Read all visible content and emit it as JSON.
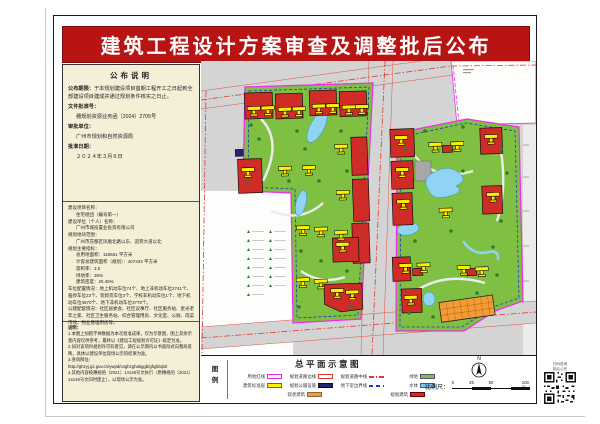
{
  "banner": {
    "title": "建筑工程设计方案审查及调整批后公布"
  },
  "panel": {
    "s1_title": "公布说明",
    "s1": [
      {
        "label": "公布期限：",
        "value": "于本规划建设项目首期工程开工之日起到全部建设项目建成并通过规划条件核实之日止。"
      },
      {
        "label": "文件批准号：",
        "value": "穗规划资源业务函〔2024〕2705号"
      },
      {
        "label": "审批单位：",
        "value": "广州市规划和自然资源局"
      },
      {
        "label": "批准日期：",
        "value": "２０２４年３月６日"
      }
    ],
    "s2": [
      {
        "label": "建设项目名称：",
        "value": "住宅组团（编号第一）"
      },
      {
        "label": "建设单位（个人）名称：",
        "value": "广州市城投置业投资有限公司"
      },
      {
        "label": "规划地块范围：",
        "value": "广州市花都区凤凰北路以东、迎宾大道以北"
      },
      {
        "label": "规划主要指标：",
        "value": ""
      },
      {
        "label": "",
        "value": "总用地面积：116551 平方米"
      },
      {
        "label": "",
        "value": "计容总建筑面积（规划）：407333 平方米"
      },
      {
        "label": "",
        "value": "容积率：3.5"
      },
      {
        "label": "",
        "value": "绿地率：35%"
      },
      {
        "label": "",
        "value": "建筑密度：25.46%"
      },
      {
        "label": "车位配置情况：",
        "value": "地上机动车位74个、地上非机动车位2741个、临停车位23个、装卸货车位3个、学校非机动车位1个、地下机动车位4870个、地下非机动车位3770个。"
      },
      {
        "label": "公建配套情况：",
        "value": "社区居委会、社区议事厅、社区服务站、星光老年之家、社区卫生服务站、综合管理用房、文化室、公厕、肉菜市场、物业管理用房等。"
      }
    ],
    "notes_title": "说明：",
    "notes": [
      "1.本图上加粗字体数据为本次批准成果，仅为示意图，图上其余示意内容仅供参考，最终以《建设工程规划许可证》核定为准。",
      "2.如对该项目规划许可有意见，请在公示期内以书面形式向我局反映，具体以建设单位现场公示的结果为准。",
      "3.查询网址：",
      "http://ghzyj.gz.gov.cn/ywpd/csghzghakggb/ghgb/qbt/",
      "4.其他内容按穗规函〔2021〕14148号文执行（原穗规函〔2021〕14148号文同时废止），以现场公示为准。"
    ]
  },
  "map": {
    "title": "总平面示意图"
  },
  "legend": {
    "caption": "图\n例",
    "items": [
      {
        "label": "用地红线"
      },
      {
        "label": "规划道路边线"
      },
      {
        "label": "规划道路中线"
      },
      {
        "label": "绿地"
      },
      {
        "label": "建筑标准层"
      },
      {
        "label": "规划公服设施"
      },
      {
        "label": "地下室边界线"
      },
      {
        "label": "水体"
      },
      {
        "label": "现状建筑"
      },
      {
        "label": "规划建筑"
      }
    ]
  },
  "scalebar": {
    "label": "比例尺：",
    "ticks": [
      "0",
      "25",
      "50",
      "100米"
    ]
  },
  "north": {
    "label": "N"
  },
  "qr": {
    "caption1": "扫码查询",
    "caption2": "批后公布"
  },
  "colors": {
    "banner_red": "#b81414",
    "panel_cream": "#f5efd8",
    "map_gray": "#d4d4d4",
    "parcel_green": "#7fc043",
    "building_red": "#cf2b27",
    "tower_yellow": "#ffee00",
    "water_blue": "#8fd4f2",
    "boundary_magenta": "#ee2bee",
    "existing_orange": "#f49b33",
    "public_navy": "#23227a"
  }
}
